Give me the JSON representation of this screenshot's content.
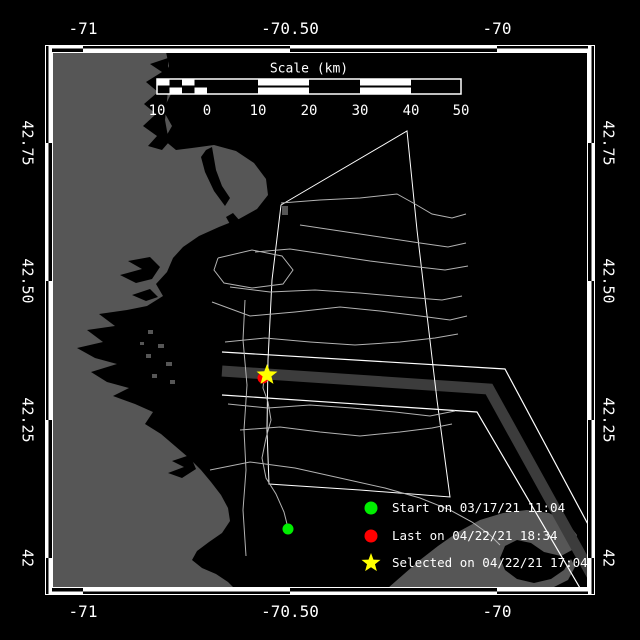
{
  "colors": {
    "background": "#000000",
    "land": "#565656",
    "ocean": "#000000",
    "track": "#b2b2b2",
    "boundary": "#ffffff",
    "lane_band": "#3c3c3c",
    "text": "#ffffff",
    "start_marker": "#00ee00",
    "last_marker": "#ff0000",
    "selected_marker": "#ffff00"
  },
  "axes": {
    "top": [
      {
        "label": "-71",
        "x": 83,
        "y": 29
      },
      {
        "label": "-70.50",
        "x": 290,
        "y": 29
      },
      {
        "label": "-70",
        "x": 497,
        "y": 29
      }
    ],
    "bottom": [
      {
        "label": "-71",
        "x": 83,
        "y": 612
      },
      {
        "label": "-70.50",
        "x": 290,
        "y": 612
      },
      {
        "label": "-70",
        "x": 497,
        "y": 612
      }
    ],
    "left": [
      {
        "label": "42.75",
        "x": 27,
        "y": 143
      },
      {
        "label": "42.50",
        "x": 27,
        "y": 281
      },
      {
        "label": "42.25",
        "x": 27,
        "y": 420
      },
      {
        "label": "42",
        "x": 27,
        "y": 558
      }
    ],
    "right": [
      {
        "label": "42.75",
        "x": 608,
        "y": 143
      },
      {
        "label": "42.50",
        "x": 608,
        "y": 281
      },
      {
        "label": "42.25",
        "x": 608,
        "y": 420
      },
      {
        "label": "42",
        "x": 608,
        "y": 558
      }
    ],
    "lon_tick_x": [
      83,
      290,
      497
    ],
    "lat_tick_y": [
      143,
      281,
      420,
      558
    ],
    "frame": {
      "outer": 45,
      "band_in": 52,
      "inner_right": 588,
      "outer_right": 595
    }
  },
  "scalebar": {
    "title": "Scale (km)",
    "title_pos": {
      "x": 309,
      "y": 69
    },
    "x0": 157,
    "x1": 461,
    "y0": 79,
    "y1": 94,
    "ticks": [
      {
        "label": "10",
        "x": 157,
        "y": 111
      },
      {
        "label": "0",
        "x": 207,
        "y": 111
      },
      {
        "label": "10",
        "x": 258,
        "y": 111
      },
      {
        "label": "20",
        "x": 309,
        "y": 111
      },
      {
        "label": "30",
        "x": 360,
        "y": 111
      },
      {
        "label": "40",
        "x": 411,
        "y": 111
      },
      {
        "label": "50",
        "x": 461,
        "y": 111
      }
    ],
    "white_segments": [
      [
        258,
        309
      ],
      [
        360,
        411
      ]
    ],
    "checker_end": 207
  },
  "legend": {
    "text_x": 392,
    "items": [
      {
        "marker": "circle",
        "color": "#00ee00",
        "label": "Start on 03/17/21 11:04",
        "x": 371,
        "y": 508
      },
      {
        "marker": "circle",
        "color": "#ff0000",
        "label": "Last on 04/22/21 18:34",
        "x": 371,
        "y": 536
      },
      {
        "marker": "star",
        "color": "#ffff00",
        "label": "Selected on 04/22/21 17:04",
        "x": 371,
        "y": 563
      }
    ]
  },
  "markers": {
    "start": {
      "x": 288,
      "y": 529,
      "r": 5.5,
      "color": "#00ee00"
    },
    "last": {
      "x": 263,
      "y": 378,
      "r": 5.5,
      "color": "#ff0000"
    },
    "selected": {
      "x": 267,
      "y": 375,
      "r": 11,
      "color": "#ffff00"
    }
  },
  "map": {
    "land": [
      [
        52,
        52
      ],
      [
        166,
        52
      ],
      [
        169,
        66
      ],
      [
        162,
        80
      ],
      [
        171,
        94
      ],
      [
        163,
        110
      ],
      [
        172,
        126
      ],
      [
        164,
        140
      ],
      [
        176,
        150
      ],
      [
        192,
        148
      ],
      [
        214,
        145
      ],
      [
        236,
        151
      ],
      [
        254,
        163
      ],
      [
        266,
        179
      ],
      [
        268,
        195
      ],
      [
        257,
        209
      ],
      [
        239,
        219
      ],
      [
        219,
        227
      ],
      [
        199,
        236
      ],
      [
        183,
        247
      ],
      [
        173,
        258
      ],
      [
        167,
        272
      ],
      [
        156,
        284
      ],
      [
        163,
        296
      ],
      [
        147,
        306
      ],
      [
        127,
        310
      ],
      [
        99,
        314
      ],
      [
        115,
        326
      ],
      [
        87,
        330
      ],
      [
        103,
        342
      ],
      [
        77,
        348
      ],
      [
        95,
        358
      ],
      [
        117,
        364
      ],
      [
        91,
        372
      ],
      [
        107,
        382
      ],
      [
        129,
        388
      ],
      [
        113,
        396
      ],
      [
        135,
        404
      ],
      [
        153,
        412
      ],
      [
        145,
        424
      ],
      [
        161,
        434
      ],
      [
        175,
        446
      ],
      [
        189,
        458
      ],
      [
        201,
        470
      ],
      [
        211,
        482
      ],
      [
        221,
        495
      ],
      [
        228,
        508
      ],
      [
        230,
        521
      ],
      [
        222,
        533
      ],
      [
        209,
        542
      ],
      [
        197,
        551
      ],
      [
        192,
        560
      ],
      [
        202,
        568
      ],
      [
        216,
        574
      ],
      [
        228,
        582
      ],
      [
        236,
        590
      ],
      [
        238,
        594
      ],
      [
        52,
        594
      ]
    ],
    "inlets": [
      [
        [
          168,
          58
        ],
        [
          150,
          64
        ],
        [
          162,
          72
        ],
        [
          146,
          82
        ],
        [
          158,
          92
        ],
        [
          144,
          104
        ],
        [
          156,
          114
        ],
        [
          143,
          126
        ],
        [
          157,
          136
        ],
        [
          148,
          146
        ],
        [
          162,
          150
        ],
        [
          169,
          142
        ],
        [
          165,
          120
        ],
        [
          168,
          90
        ]
      ],
      [
        [
          206,
          150
        ],
        [
          212,
          147
        ],
        [
          216,
          170
        ],
        [
          222,
          186
        ],
        [
          230,
          198
        ],
        [
          225,
          206
        ],
        [
          214,
          191
        ],
        [
          205,
          172
        ],
        [
          201,
          157
        ]
      ],
      [
        [
          233,
          213
        ],
        [
          240,
          221
        ],
        [
          231,
          226
        ],
        [
          226,
          217
        ]
      ],
      [
        [
          150,
          257
        ],
        [
          128,
          261
        ],
        [
          142,
          269
        ],
        [
          120,
          275
        ],
        [
          136,
          283
        ],
        [
          152,
          279
        ],
        [
          160,
          267
        ]
      ],
      [
        [
          150,
          289
        ],
        [
          132,
          295
        ],
        [
          146,
          301
        ],
        [
          158,
          297
        ]
      ],
      [
        [
          190,
          455
        ],
        [
          172,
          461
        ],
        [
          184,
          467
        ],
        [
          168,
          473
        ],
        [
          182,
          478
        ],
        [
          196,
          469
        ]
      ],
      [
        [
          224,
          534
        ],
        [
          212,
          543
        ],
        [
          202,
          552
        ],
        [
          200,
          559
        ],
        [
          210,
          564
        ],
        [
          220,
          559
        ],
        [
          227,
          547
        ]
      ]
    ],
    "islands": [
      [
        282,
        206,
        6,
        9
      ],
      [
        148,
        330,
        5,
        4
      ],
      [
        158,
        344,
        6,
        4
      ],
      [
        146,
        354,
        5,
        4
      ],
      [
        166,
        362,
        6,
        4
      ],
      [
        152,
        374,
        5,
        4
      ],
      [
        170,
        380,
        5,
        4
      ],
      [
        140,
        342,
        4,
        3
      ]
    ],
    "hook": [
      [
        388,
        588
      ],
      [
        404,
        574
      ],
      [
        420,
        560
      ],
      [
        438,
        546
      ],
      [
        458,
        532
      ],
      [
        480,
        520
      ],
      [
        503,
        513
      ],
      [
        527,
        510
      ],
      [
        549,
        513
      ],
      [
        567,
        522
      ],
      [
        577,
        535
      ],
      [
        574,
        549
      ],
      [
        561,
        556
      ],
      [
        544,
        552
      ],
      [
        531,
        543
      ],
      [
        517,
        540
      ],
      [
        505,
        546
      ],
      [
        500,
        558
      ],
      [
        505,
        570
      ],
      [
        517,
        579
      ],
      [
        534,
        583
      ],
      [
        551,
        579
      ],
      [
        564,
        570
      ],
      [
        571,
        559
      ],
      [
        575,
        567
      ],
      [
        568,
        580
      ],
      [
        552,
        588
      ]
    ],
    "sanctuary": [
      [
        281,
        205
      ],
      [
        407,
        131
      ],
      [
        417,
        230
      ],
      [
        427,
        315
      ],
      [
        437,
        400
      ],
      [
        450,
        497
      ],
      [
        360,
        490
      ],
      [
        269,
        484
      ],
      [
        267,
        430
      ],
      [
        268,
        360
      ],
      [
        272,
        280
      ]
    ],
    "lane_band": [
      [
        222,
        371
      ],
      [
        489,
        389
      ],
      [
        610,
        608
      ]
    ],
    "lane_lines": [
      [
        [
          222,
          352
        ],
        [
          505,
          369
        ],
        [
          622,
          588
        ]
      ],
      [
        [
          222,
          395
        ],
        [
          477,
          412
        ],
        [
          580,
          588
        ]
      ]
    ],
    "tracks": [
      [
        [
          245,
          300
        ],
        [
          243,
          340
        ],
        [
          247,
          385
        ],
        [
          244,
          430
        ],
        [
          246,
          470
        ],
        [
          243,
          510
        ],
        [
          246,
          556
        ]
      ],
      [
        [
          288,
          528
        ],
        [
          284,
          512
        ],
        [
          276,
          494
        ],
        [
          266,
          478
        ],
        [
          262,
          458
        ],
        [
          266,
          438
        ],
        [
          271,
          420
        ],
        [
          268,
          402
        ],
        [
          263,
          388
        ],
        [
          264,
          379
        ]
      ],
      [
        [
          281,
          203
        ],
        [
          320,
          200
        ],
        [
          360,
          198
        ],
        [
          397,
          194
        ],
        [
          415,
          204
        ],
        [
          432,
          214
        ],
        [
          452,
          218
        ],
        [
          466,
          214
        ]
      ],
      [
        [
          300,
          225
        ],
        [
          340,
          231
        ],
        [
          380,
          237
        ],
        [
          420,
          243
        ],
        [
          448,
          247
        ],
        [
          466,
          243
        ]
      ],
      [
        [
          255,
          252
        ],
        [
          290,
          249
        ],
        [
          330,
          255
        ],
        [
          370,
          261
        ],
        [
          410,
          266
        ],
        [
          445,
          270
        ],
        [
          468,
          266
        ]
      ],
      [
        [
          218,
          258
        ],
        [
          252,
          250
        ],
        [
          282,
          256
        ],
        [
          293,
          270
        ],
        [
          283,
          284
        ],
        [
          252,
          288
        ],
        [
          224,
          283
        ],
        [
          214,
          270
        ],
        [
          218,
          258
        ]
      ],
      [
        [
          230,
          287
        ],
        [
          270,
          292
        ],
        [
          315,
          290
        ],
        [
          360,
          293
        ],
        [
          405,
          297
        ],
        [
          442,
          300
        ],
        [
          462,
          296
        ]
      ],
      [
        [
          212,
          302
        ],
        [
          250,
          316
        ],
        [
          295,
          312
        ],
        [
          340,
          307
        ],
        [
          380,
          311
        ],
        [
          420,
          316
        ],
        [
          450,
          320
        ],
        [
          467,
          316
        ]
      ],
      [
        [
          225,
          342
        ],
        [
          265,
          338
        ],
        [
          310,
          342
        ],
        [
          355,
          345
        ],
        [
          400,
          342
        ],
        [
          435,
          338
        ],
        [
          458,
          334
        ]
      ],
      [
        [
          228,
          404
        ],
        [
          268,
          408
        ],
        [
          310,
          405
        ],
        [
          352,
          408
        ],
        [
          395,
          412
        ],
        [
          430,
          416
        ],
        [
          455,
          411
        ]
      ],
      [
        [
          240,
          430
        ],
        [
          280,
          427
        ],
        [
          320,
          432
        ],
        [
          360,
          436
        ],
        [
          400,
          432
        ],
        [
          432,
          428
        ],
        [
          452,
          424
        ]
      ],
      [
        [
          210,
          470
        ],
        [
          250,
          462
        ],
        [
          295,
          468
        ],
        [
          340,
          478
        ],
        [
          385,
          488
        ],
        [
          420,
          498
        ],
        [
          450,
          510
        ],
        [
          472,
          522
        ],
        [
          490,
          535
        ],
        [
          500,
          545
        ]
      ]
    ]
  }
}
